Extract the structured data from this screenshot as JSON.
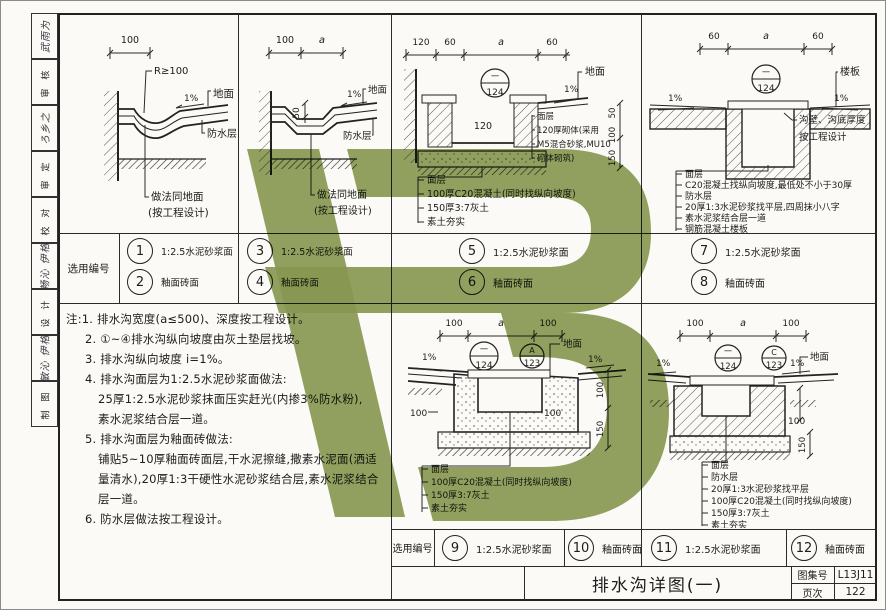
{
  "colors": {
    "line": "#2b2b2b",
    "paper": "#fbfaf6",
    "watermark_green": "#8a9b55"
  },
  "sidebar": {
    "cells": [
      {
        "kind": "sig",
        "text": "武雨为"
      },
      {
        "kind": "label",
        "text": "审 核"
      },
      {
        "kind": "sig",
        "text": "ろ乡之"
      },
      {
        "kind": "label",
        "text": "审 定"
      },
      {
        "kind": "label",
        "text": "校 对"
      },
      {
        "kind": "sig",
        "text": "戴畅沁 伊格沁"
      },
      {
        "kind": "label",
        "text": "设 计"
      },
      {
        "kind": "sig",
        "text": "釋敏沁 伊格沁"
      },
      {
        "kind": "label",
        "text": "制 图"
      }
    ]
  },
  "selection_row_1": {
    "label": "选用编号",
    "items": [
      {
        "num": "1",
        "desc": "1:2.5水泥砂浆面"
      },
      {
        "num": "2",
        "desc": "釉面砖面"
      },
      {
        "num": "3",
        "desc": "1:2.5水泥砂浆面"
      },
      {
        "num": "4",
        "desc": "釉面砖面"
      },
      {
        "num": "5",
        "desc": "1:2.5水泥砂浆面"
      },
      {
        "num": "6",
        "desc": "釉面砖面"
      },
      {
        "num": "7",
        "desc": "1:2.5水泥砂浆面"
      },
      {
        "num": "8",
        "desc": "釉面砖面"
      }
    ]
  },
  "selection_row_2": {
    "label": "选用编号",
    "items": [
      {
        "num": "9",
        "desc": "1:2.5水泥砂浆面"
      },
      {
        "num": "10",
        "desc": "釉面砖面"
      },
      {
        "num": "11",
        "desc": "1:2.5水泥砂浆面"
      },
      {
        "num": "12",
        "desc": "釉面砖面"
      }
    ]
  },
  "notes": {
    "lines": [
      "注:1. 排水沟宽度(a≤500)、深度按工程设计。",
      "2. ①~④排水沟纵向坡度由灰土垫层找坡。",
      "3. 排水沟纵向坡度 i=1%。",
      "4. 排水沟面层为1:2.5水泥砂浆面做法:",
      "25厚1:2.5水泥砂浆抹面压实赶光(内掺3%防水粉),",
      "素水泥浆结合层一道。",
      "5. 排水沟面层为釉面砖做法:",
      "铺贴5~10厚釉面砖面层,干水泥擦缝,撒素水泥面(洒适",
      "量清水),20厚1:3干硬性水泥砂浆结合层,素水泥浆结合",
      "层一道。",
      "6. 防水层做法按工程设计。"
    ]
  },
  "title_block": {
    "drawing_title": "排水沟详图(一)",
    "atlas_label": "图集号",
    "atlas_no": "L13J11",
    "page_label": "页次",
    "page_no": "122"
  },
  "details": {
    "d1": {
      "dim1": "100",
      "r": "R≥100",
      "slope": "1%",
      "ground": "地面",
      "wp": "防水层",
      "note1": "做法同地面",
      "note2": "(按工程设计)"
    },
    "d2": {
      "dim1": "100",
      "dim2": "a",
      "depth": "50",
      "slope": "1%",
      "ground": "地面",
      "wp": "防水层",
      "note1": "做法同地面",
      "note2": "(按工程设计)"
    },
    "d3": {
      "dims": [
        "120",
        "60",
        "a",
        "60"
      ],
      "bubble_top": "一",
      "bubble_btm": "124",
      "inner": "120",
      "slope": "1%",
      "ground": "地面",
      "vdims": [
        "50",
        "100",
        "150"
      ],
      "right": [
        "面层",
        "120厚砌体(采用",
        "M5混合砂浆,MU10",
        "砌体砌筑)"
      ],
      "bottom": [
        "面层",
        "100厚C20混凝土(同时找纵向坡度)",
        "150厚3:7灰土",
        "素土夯实"
      ]
    },
    "d4": {
      "dims": [
        "60",
        "a",
        "60"
      ],
      "bubble_top": "一",
      "bubble_btm": "124",
      "slope1": "1%",
      "slope2": "1%",
      "slab": "楼板",
      "right": [
        "沟壁、沟底厚度",
        "按工程设计"
      ],
      "bottom": [
        "面层",
        "C20混凝土找纵向坡度,最低处不小于30厚",
        "防水层",
        "20厚1:3水泥砂浆找平层,四周抹小八字",
        "素水泥浆结合层一道",
        "钢筋混凝土楼板"
      ]
    },
    "d5": {
      "dims": [
        "100",
        "a",
        "100"
      ],
      "b1t": "一",
      "b1b": "124",
      "b2t": "A",
      "b2b": "123",
      "slope1": "1%",
      "slope2": "1%",
      "ground": "地面",
      "dimL": "100",
      "dimR": "100",
      "v1": "100",
      "v2": "150",
      "bottom": [
        "面层",
        "100厚C20混凝土(同时找纵向坡度)",
        "150厚3:7灰土",
        "素土夯实"
      ]
    },
    "d6": {
      "dims": [
        "100",
        "a",
        "100"
      ],
      "b1t": "一",
      "b1b": "124",
      "b2t": "C",
      "b2b": "123",
      "slope1": "1%",
      "slope2": "1%",
      "ground": "地面",
      "v1": "100",
      "v2": "150",
      "bottom": [
        "面层",
        "防水层",
        "20厚1:3水泥砂浆找平层",
        "100厚C20混凝土(同时找纵向坡度)",
        "150厚3:7灰土",
        "素土夯实"
      ]
    }
  }
}
